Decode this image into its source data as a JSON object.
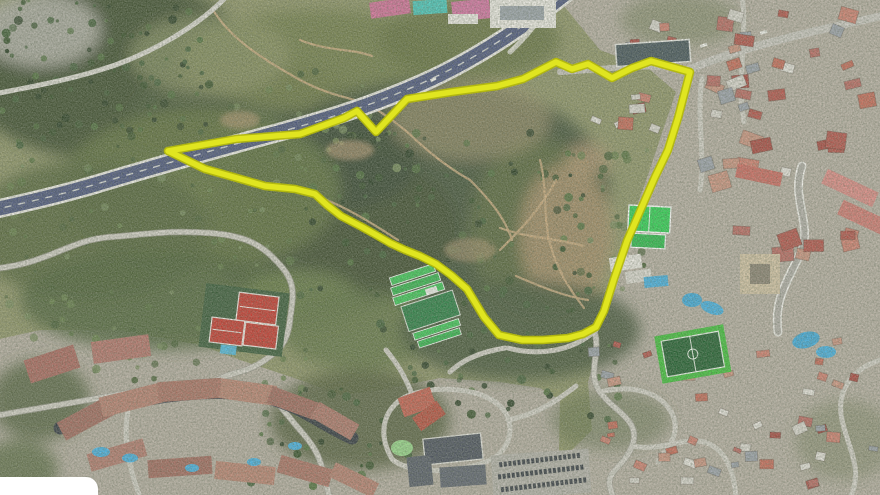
{
  "map": {
    "kind": "satellite-aerial-photograph",
    "overlay": {
      "name": "highlighted-parcel-boundary",
      "points": "168,151 236,139 300,134 344,118 357,111 376,132 407,99 452,92 497,86 523,79 556,62 572,69 588,64 612,78 632,68 651,61 690,72 678,118 668,150 655,177 641,209 627,241 614,279 604,311 596,327 583,334 568,338 543,340 522,340 499,335 484,317 467,289 451,275 436,264 420,256 405,250 390,243 378,236 362,227 341,216 327,205 315,194 295,189 265,186 237,178 205,169",
      "stroke": "#e0e520",
      "casing": "#b4b90c"
    },
    "colors": {
      "base_terrain": "#8f9468",
      "forest_dark": "#3a4a2e",
      "scrub_olive": "#707b48",
      "bare_ground": "#b1936f",
      "urban_ground": "#b5aea1",
      "highway_asphalt": "#4c567c",
      "highway_edge": "#eceae4",
      "road_light": "#cfccc3",
      "roof_red": "#b2544b",
      "tennis_court_red": "#c23a30",
      "sports_roof_bright": "#3ec457",
      "sports_roof_dark": "#2b7d44",
      "courts_green": "#2ecf52",
      "pitch_green_dark": "#215e2f",
      "pitch_green_bright": "#3fbe3a",
      "pool_blue": "#45aede",
      "attribution_box": "#ffffff"
    },
    "landmarks": [
      "highway",
      "highlighted-parcel-boundary",
      "tennis-courts",
      "sports-complex",
      "green-courts",
      "soccer-field",
      "residential-complex",
      "parking-lot",
      "urban-district",
      "forest-parkland",
      "attribution-box"
    ]
  }
}
